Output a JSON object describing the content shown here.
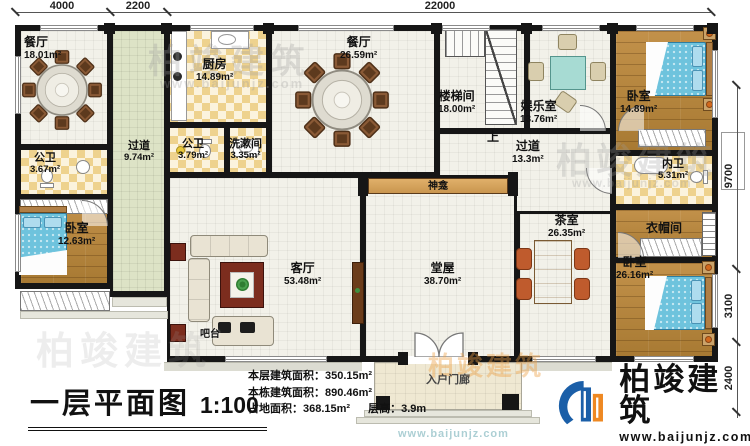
{
  "dims": {
    "top": [
      "4000",
      "2200",
      "22000"
    ],
    "right": [
      "9700",
      "3100",
      "2400"
    ]
  },
  "rooms": {
    "dining1": {
      "name": "餐厅",
      "area": "18.01m²"
    },
    "corridorL": {
      "name": "过道",
      "area": "9.74m²"
    },
    "kitchen": {
      "name": "厨房",
      "area": "14.89m²"
    },
    "bathM": {
      "name": "公卫",
      "area": "3.79m²"
    },
    "wash": {
      "name": "洗漱间",
      "area": "3.35m²"
    },
    "dining2": {
      "name": "餐厅",
      "area": "26.59m²"
    },
    "stair": {
      "name": "楼梯间",
      "area": "18.00m²"
    },
    "ent": {
      "name": "娱乐室",
      "area": "13.76m²"
    },
    "bedroomTR": {
      "name": "卧室",
      "area": "14.89m²"
    },
    "bathL": {
      "name": "公卫",
      "area": "3.67m²"
    },
    "bedroomL": {
      "name": "卧室",
      "area": "12.63m²"
    },
    "corridorR": {
      "name": "过道",
      "area": "13.3m²"
    },
    "bathR": {
      "name": "内卫",
      "area": "5.31m²"
    },
    "closet": {
      "name": "衣帽间"
    },
    "tea": {
      "name": "茶室",
      "area": "26.35m²"
    },
    "bedroomBR": {
      "name": "卧室",
      "area": "26.16m²"
    },
    "living": {
      "name": "客厅",
      "area": "53.48m²"
    },
    "hall": {
      "name": "堂屋",
      "area": "38.70m²"
    }
  },
  "labels": {
    "up": "上",
    "shrine": "神龛",
    "bar": "吧台",
    "porch": "入户门廊"
  },
  "footer": {
    "title": "一层平面图",
    "scale": "1:100",
    "stats": [
      {
        "label": "本层建筑面积：",
        "value": "350.15m²"
      },
      {
        "label": "本栋建筑面积：",
        "value": "890.46m²"
      },
      {
        "label": "占地面积：",
        "value": "368.15m²",
        "label2": "层高：",
        "value2": "3.9m"
      }
    ]
  },
  "brand": {
    "name": "柏竣建筑",
    "url": "www.baijunjz.com"
  },
  "colors": {
    "wall": "#161616",
    "logoBlue": "#1b5fa8",
    "logoOrange": "#ee8822",
    "bed": "#6ec3dd",
    "corridor": "#dde3c6"
  }
}
